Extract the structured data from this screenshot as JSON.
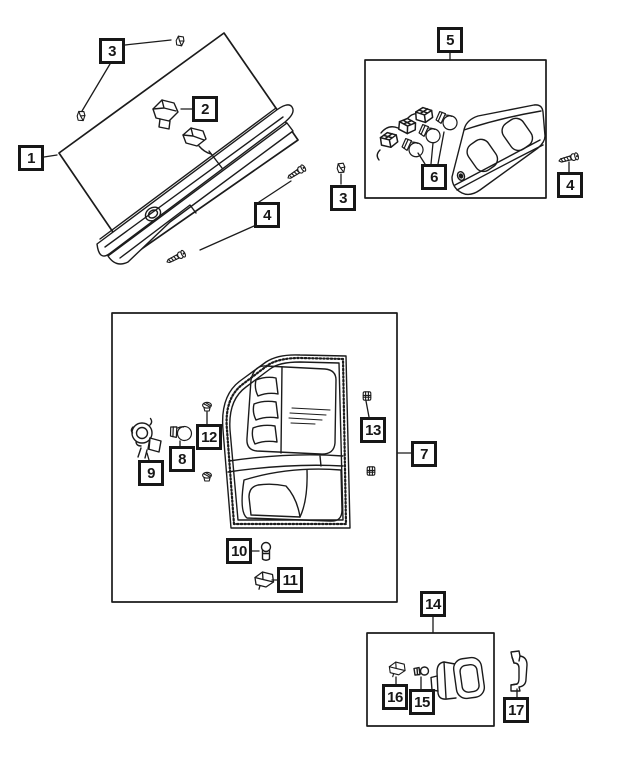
{
  "page": {
    "background": "#ffffff",
    "line_color": "#1b1b1b"
  },
  "callouts": {
    "n1": "1",
    "n2": "2",
    "n3": "3",
    "n4": "4",
    "n5": "5",
    "n6": "6",
    "n7": "7",
    "n8": "8",
    "n9": "9",
    "n10": "10",
    "n11": "11",
    "n12": "12",
    "n13": "13",
    "n14": "14",
    "n15": "15",
    "n16": "16",
    "n17": "17"
  }
}
